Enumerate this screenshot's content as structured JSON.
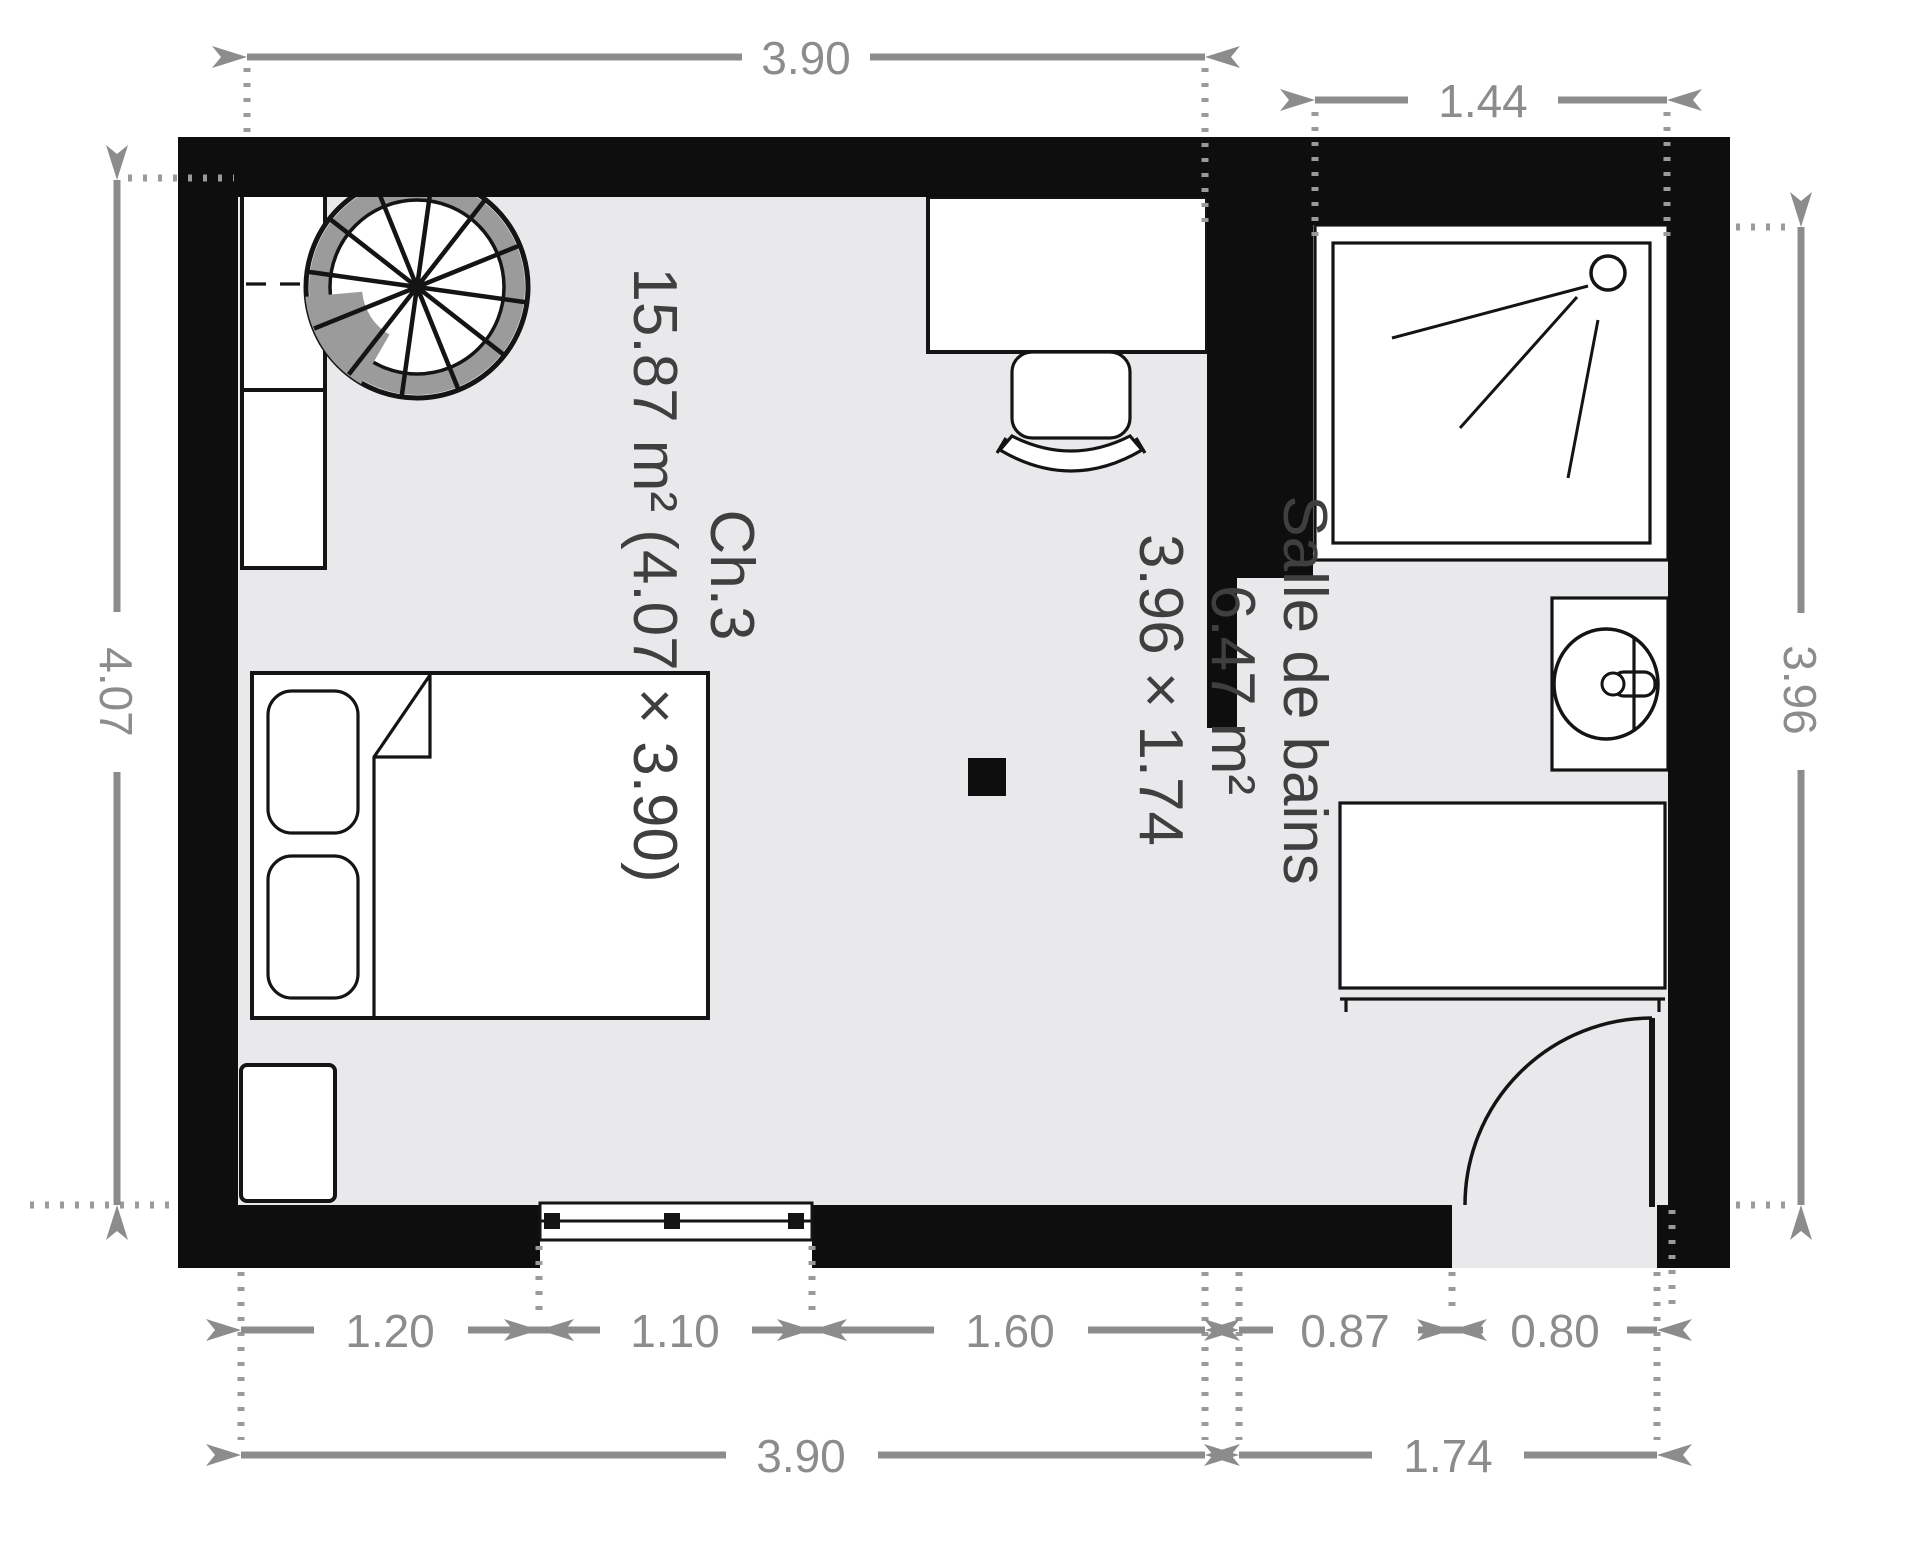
{
  "plan_title": "floor-plan",
  "rooms": {
    "bedroom": {
      "label": "Ch.3",
      "details": "15.87 m² (4.07 × 3.90)"
    },
    "bathroom": {
      "label": "Salle de bains",
      "area": "6.47 m²",
      "size": "3.96 × 1.74"
    }
  },
  "dimensions": {
    "top_bedroom_width": "3.90",
    "top_bathroom_width": "1.44",
    "left_height": "4.07",
    "right_height": "3.96",
    "bottom_segments": [
      "1.20",
      "1.10",
      "1.60",
      "0.87",
      "0.80"
    ],
    "bottom_total_bedroom": "3.90",
    "bottom_total_bathroom": "1.74"
  },
  "furniture": [
    "spiral-staircase",
    "wardrobe",
    "double-bed",
    "pillows",
    "nightstand",
    "desk",
    "office-chair",
    "shower",
    "washbasin",
    "bathroom-cabinet",
    "window",
    "door-swing",
    "pillar"
  ],
  "colors": {
    "wall": "#0e0e0e",
    "floor": "#e9e9eb",
    "dimension_gray": "#8c8c8c",
    "label_gray": "#3f3f3f",
    "stair_ring_gray": "#9b9b9b",
    "background": "#ffffff"
  }
}
